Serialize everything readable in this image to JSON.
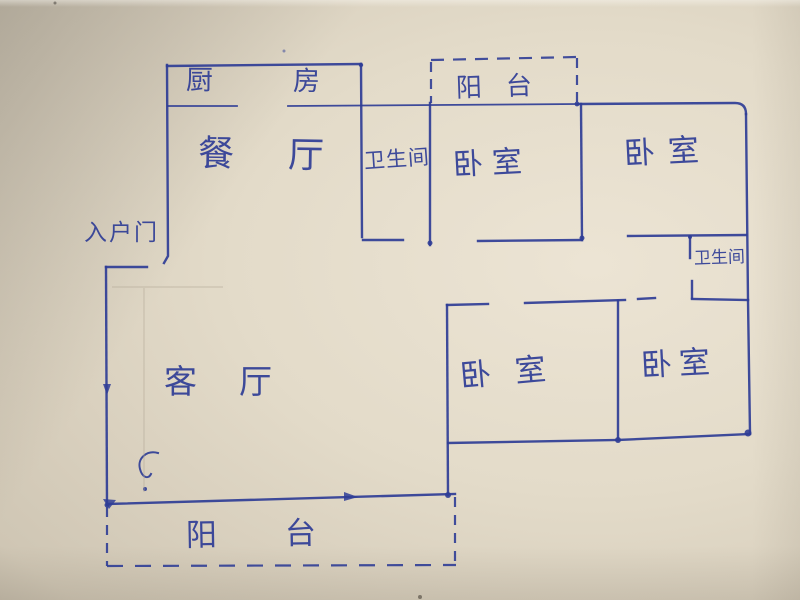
{
  "palette": {
    "paper": "#d8cfbd",
    "paper_light": "#ece4d4",
    "ink": "#2f3d96",
    "pencil": "#b3a997"
  },
  "rooms": {
    "kitchen": {
      "label": "厨房"
    },
    "dining": {
      "label": "餐厅"
    },
    "balcony_top": {
      "label": "阳台"
    },
    "bathroom_top": {
      "label": "卫生间"
    },
    "bedroom_top_middle": {
      "label": "卧室"
    },
    "bedroom_top_right": {
      "label": "卧室"
    },
    "bathroom_right": {
      "label": "卫生间"
    },
    "entrance_door": {
      "label": "入户门"
    },
    "living": {
      "label": "客厅"
    },
    "bedroom_bottom_left": {
      "label": "卧室"
    },
    "bedroom_bottom_right": {
      "label": "卧室"
    },
    "balcony_bottom": {
      "label": "阳台"
    }
  }
}
